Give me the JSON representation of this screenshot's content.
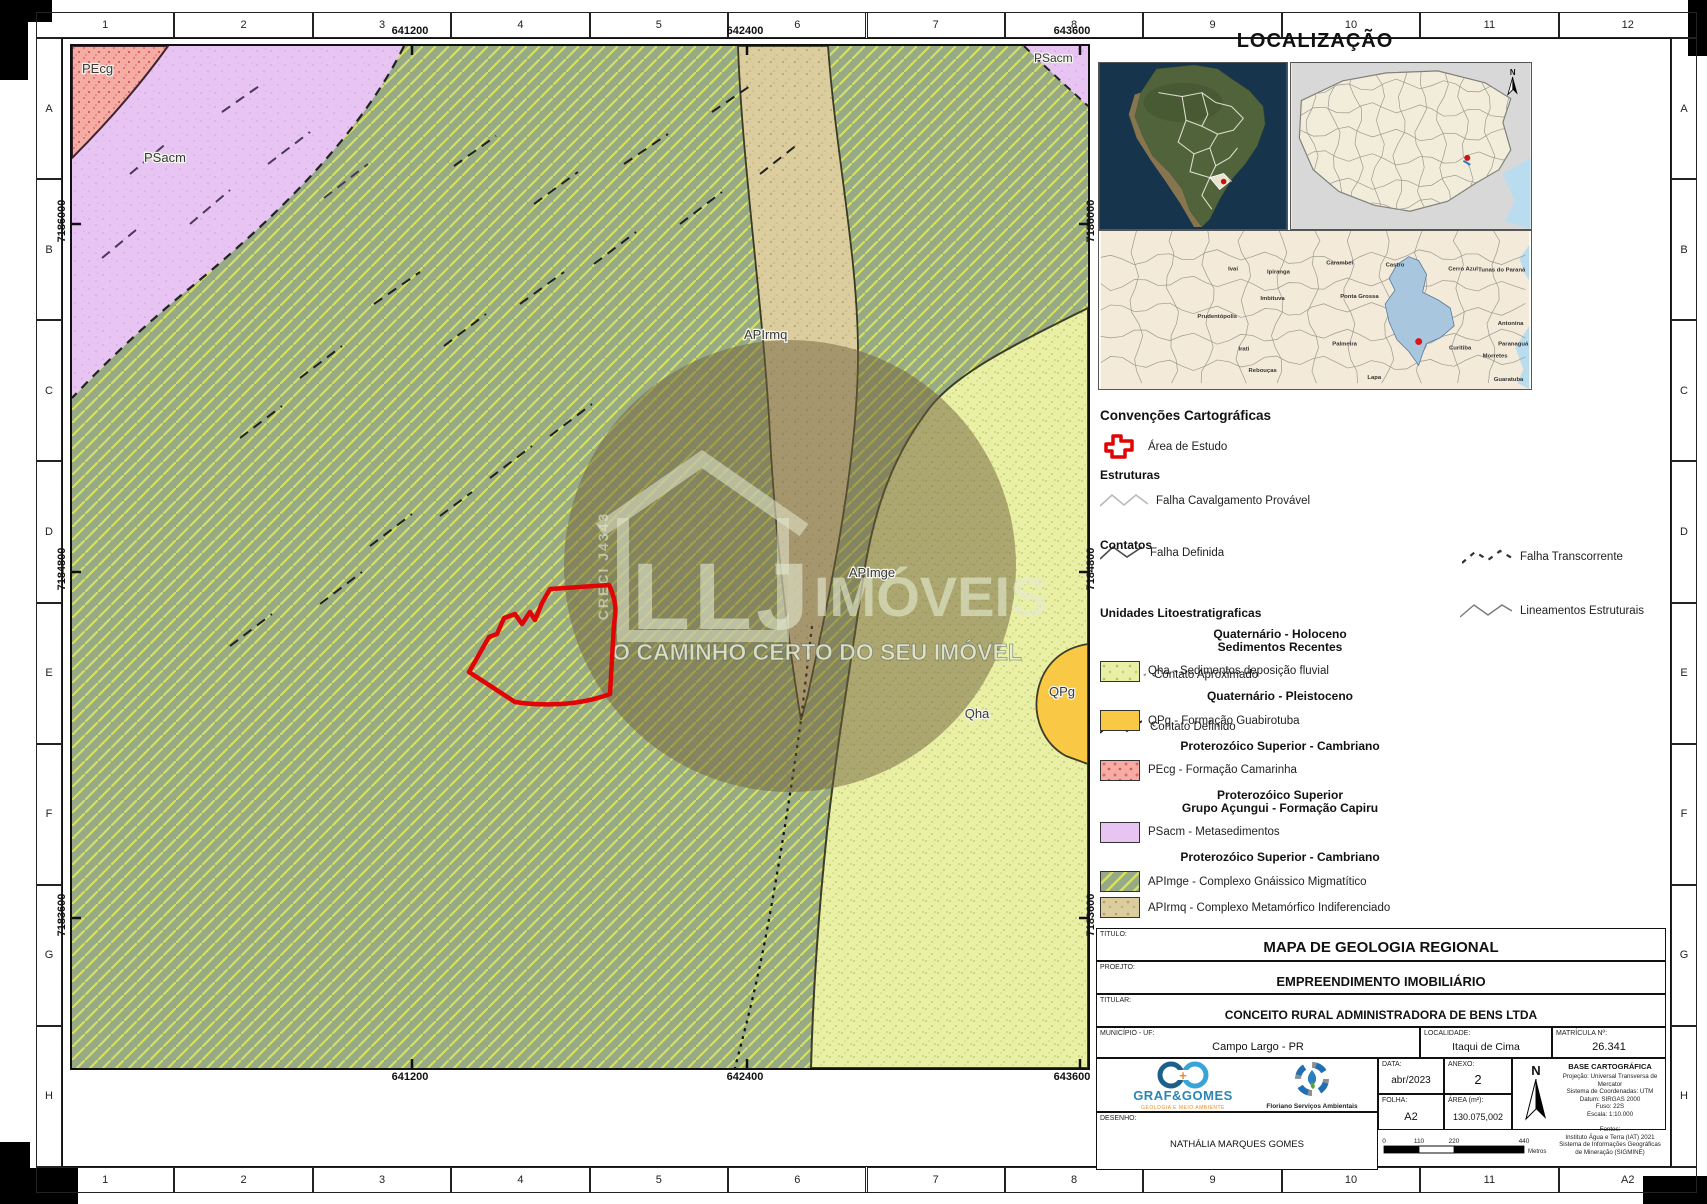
{
  "sheet": {
    "cols_top": [
      "1",
      "2",
      "3",
      "4",
      "5",
      "6",
      "7",
      "8",
      "9",
      "10",
      "11",
      "12"
    ],
    "cols_bottom": [
      "1",
      "2",
      "3",
      "4",
      "5",
      "6",
      "7",
      "8",
      "9",
      "10",
      "11",
      "A2"
    ],
    "rows": [
      "A",
      "B",
      "C",
      "D",
      "E",
      "F",
      "G",
      "H"
    ]
  },
  "map": {
    "coords_x": [
      "641200",
      "642400",
      "643600"
    ],
    "coords_y": [
      "7186000",
      "7184800",
      "7183600"
    ],
    "labels": {
      "pecg": "PEcg",
      "psacm": "PSacm",
      "psacm2": "PSacm",
      "apirmq": "APIrmq",
      "apimge": "APImge",
      "qha": "Qha",
      "qpg": "QPg"
    }
  },
  "watermark": {
    "brand": "LLJ",
    "word": "IMÓVEIS",
    "tagline": "O CAMINHO CERTO DO SEU IMÓVEL",
    "creci": "CRECI J4343"
  },
  "localizacao": {
    "title": "LOCALIZAÇÃO",
    "north": "N",
    "municipios": [
      {
        "n": "Ivaí",
        "x": 134,
        "y": 40
      },
      {
        "n": "Ipiranga",
        "x": 180,
        "y": 43
      },
      {
        "n": "Carambeí",
        "x": 242,
        "y": 34
      },
      {
        "n": "Castro",
        "x": 298,
        "y": 36
      },
      {
        "n": "Cerro Azul",
        "x": 367,
        "y": 40
      },
      {
        "n": "Tunas do Paraná",
        "x": 430,
        "y": 41,
        "a": "end"
      },
      {
        "n": "Imbituva",
        "x": 174,
        "y": 70
      },
      {
        "n": "Ponta Grossa",
        "x": 262,
        "y": 68
      },
      {
        "n": "Prudentópolis",
        "x": 118,
        "y": 88
      },
      {
        "n": "Palmeira",
        "x": 247,
        "y": 116
      },
      {
        "n": "Irati",
        "x": 145,
        "y": 121
      },
      {
        "n": "Rebouças",
        "x": 164,
        "y": 143
      },
      {
        "n": "Lapa",
        "x": 277,
        "y": 150
      },
      {
        "n": "Curitiba",
        "x": 364,
        "y": 120
      },
      {
        "n": "Antonina",
        "x": 428,
        "y": 95,
        "a": "end"
      },
      {
        "n": "Morretes",
        "x": 412,
        "y": 128,
        "a": "end"
      },
      {
        "n": "Paranaguá",
        "x": 433,
        "y": 116,
        "a": "end"
      },
      {
        "n": "Guaratuba",
        "x": 428,
        "y": 152,
        "a": "end"
      }
    ]
  },
  "legend": {
    "title": "Convenções Cartográficas",
    "area_estudo": "Área de Estudo",
    "estruturas_title": "Estruturas",
    "falha_cavalgamento": "Falha Cavalgamento Provável",
    "falha_definida": "Falha Definida",
    "falha_transcorrente": "Falha Transcorrente",
    "lineamentos": "Lineamentos Estruturais",
    "contatos_title": "Contatos",
    "contato_aproximado": "Contato Aproximado",
    "contato_definido": "Contato Definido",
    "unidades_title": "Unidades Litoestratigraficas",
    "groups": [
      {
        "heading": [
          "Quaternário - Holoceno",
          "Sedimentos Recentes"
        ],
        "items": [
          {
            "key": "qha",
            "label": "Qha - Sedimentos deposição fluvial"
          }
        ]
      },
      {
        "heading": [
          "Quaternário - Pleistoceno"
        ],
        "items": [
          {
            "key": "qpg",
            "label": "QPg - Formação Guabirotuba"
          }
        ]
      },
      {
        "heading": [
          "Proterozóico Superior - Cambriano"
        ],
        "items": [
          {
            "key": "pecg",
            "label": "PEcg - Formação Camarinha"
          }
        ]
      },
      {
        "heading": [
          "Proterozóico Superior",
          "Grupo Açungui - Formação Capiru"
        ],
        "items": [
          {
            "key": "psacm",
            "label": "PSacm - Metasedimentos"
          }
        ]
      },
      {
        "heading": [
          "Proterozóico Superior - Cambriano"
        ],
        "items": [
          {
            "key": "apimge",
            "label": "APImge - Complexo Gnáissico Migmatítico"
          },
          {
            "key": "apirmq",
            "label": "APIrmq - Complexo Metamórfico Indiferenciado"
          }
        ]
      }
    ]
  },
  "titleblock": {
    "titulo_label": "TITULO:",
    "titulo": "MAPA DE GEOLOGIA REGIONAL",
    "projeto_label": "PROEJTO:",
    "projeto": "EMPREENDIMENTO IMOBILIÁRIO",
    "titular_label": "TITULAR:",
    "titular": "CONCEITO RURAL ADMINISTRADORA DE BENS LTDA",
    "municipio_label": "MUNICÍPIO - UF:",
    "municipio": "Campo Largo - PR",
    "localidade_label": "LOCALIDADE:",
    "localidade": "Itaqui de Cima",
    "matricula_label": "MATRÍCULA Nº:",
    "matricula": "26.341",
    "data_label": "DATA:",
    "data": "abr/2023",
    "anexo_label": "ANEXO:",
    "anexo": "2",
    "folha_label": "FOLHA:",
    "folha": "A2",
    "area_label": "ÁREA (m²):",
    "area": "130.075,002",
    "desenho_label": "DESENHO:",
    "desenho": "NATHÁLIA MARQUES GOMES",
    "north": "N",
    "base": {
      "title": "BASE CARTOGRÁFICA",
      "lines": [
        "Projeção: Universal Transversa de Mercator",
        "Sistema de Coordenadas: UTM",
        "Datum: SIRGAS 2000",
        "Fuso: 22S",
        "Escala: 1:10.000"
      ],
      "fontes_label": "Fontes:",
      "fontes": [
        "Instituto Água e Terra (IAT) 2021",
        "Sistema de Informações Geográficas",
        "de Mineração (SIGMINE)"
      ]
    },
    "logos": {
      "graf_name": "GRAF&GOMES",
      "graf_sub": "GEOLOGIA E MEIO AMBIENTE",
      "floriano": "Floriano Serviços Ambientais"
    },
    "scalebar": {
      "ticks": [
        "0",
        "110",
        "220",
        "440"
      ],
      "unit": "Metros"
    }
  },
  "colors": {
    "apimge_green": "#96aa86",
    "hatch_yellow": "#d7df5f",
    "psacm_purple": "#e8c4f3",
    "pecg_pink": "#f5aca5",
    "apirmq_tan": "#dccd9f",
    "qha_yellow": "#e9efa4",
    "qpg_orange": "#f9c845",
    "study_red": "#e10404",
    "highlight_blue": "#a9c6df"
  }
}
